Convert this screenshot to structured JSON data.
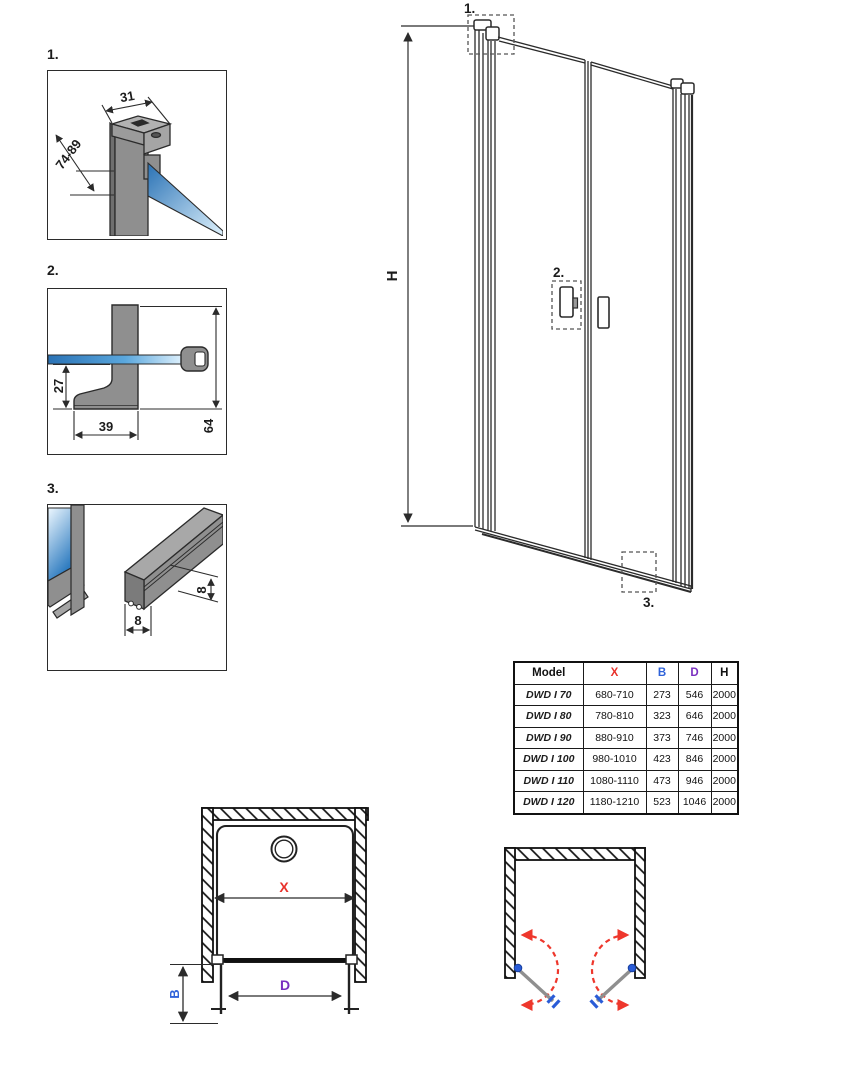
{
  "details": [
    {
      "label": "1.",
      "dim_profile_width": "31",
      "dim_adjust_range": "74-89"
    },
    {
      "label": "2.",
      "dim_glass_to_bottom": "27",
      "dim_foot_width": "39",
      "dim_total_height": "64"
    },
    {
      "label": "3.",
      "dim_height": "8",
      "dim_width": "8"
    }
  ],
  "elevation": {
    "dim_height_label": "H",
    "callout_1": "1.",
    "callout_2": "2.",
    "callout_3": "3."
  },
  "plan": {
    "dim_width_label": "X",
    "dim_side_label": "B",
    "dim_door_label": "D"
  },
  "table": {
    "headers": [
      {
        "label": "Model"
      },
      {
        "label": "X"
      },
      {
        "label": "B"
      },
      {
        "label": "D"
      },
      {
        "label": "H"
      }
    ],
    "rows": [
      {
        "model": "DWD I 70",
        "x": "680-710",
        "b": "273",
        "d": "546",
        "h": "2000"
      },
      {
        "model": "DWD I 80",
        "x": "780-810",
        "b": "323",
        "d": "646",
        "h": "2000"
      },
      {
        "model": "DWD I 90",
        "x": "880-910",
        "b": "373",
        "d": "746",
        "h": "2000"
      },
      {
        "model": "DWD I 100",
        "x": "980-1010",
        "b": "423",
        "d": "846",
        "h": "2000"
      },
      {
        "model": "DWD I 110",
        "x": "1080-1110",
        "b": "473",
        "d": "946",
        "h": "2000"
      },
      {
        "model": "DWD I 120",
        "x": "1180-1210",
        "b": "523",
        "d": "1046",
        "h": "2000"
      }
    ]
  },
  "colors": {
    "line": "#2b2b2b",
    "accent_x": "#e8312a",
    "accent_b": "#2f62d9",
    "accent_d": "#7a2fc0",
    "swing_arrow": "#ee372c",
    "hinge_blue": "#2a5cd7",
    "glass_dark": "#2a72b5",
    "glass_light": "#e8f6fe"
  }
}
